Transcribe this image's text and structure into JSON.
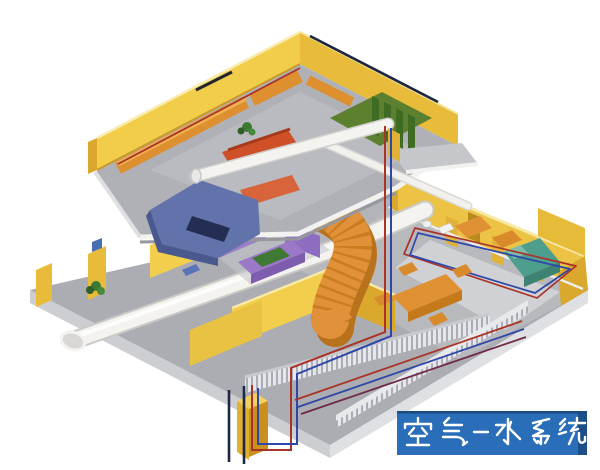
{
  "caption": {
    "text": "空气-水系统"
  },
  "palette": {
    "caption_bg": "#2a6db8",
    "caption_border": "#1a4a80",
    "caption_text": "#ffffff",
    "wall_yellow_lit": "#f2cd4a",
    "wall_yellow_shade": "#d9a82c",
    "floor_gray": "#abadb2",
    "slab_edge_gray": "#dfe0e3",
    "duct_white": "#f4f3f0",
    "stair_orange": "#e0913a",
    "stair_shadow": "#b8721c",
    "pipe_red": "#aa3328",
    "pipe_blue": "#2f47a8",
    "pipe_navy": "#1d2742",
    "sofa_purple": "#9b79c8",
    "furniture_orange": "#e09133",
    "couch_red": "#cf4f28",
    "piano_slate": "#6272aa",
    "accent_teal": "#4e9e8e",
    "accent_green": "#5d8030",
    "plant_green": "#3c7a33"
  },
  "scene": {
    "floors": [
      "upper-floor",
      "lower-floor"
    ],
    "systems": [
      "white-air-duct",
      "red-pipe-run",
      "blue-pipe-run",
      "navy-pipe-run"
    ],
    "objects": [
      "staircase",
      "purple-sofa-set",
      "dining-table-set",
      "piano",
      "balcony",
      "green-mat",
      "window-blinds",
      "teal-bed",
      "round-tables",
      "plants",
      "radiator-railing",
      "bathroom-fixtures"
    ]
  }
}
